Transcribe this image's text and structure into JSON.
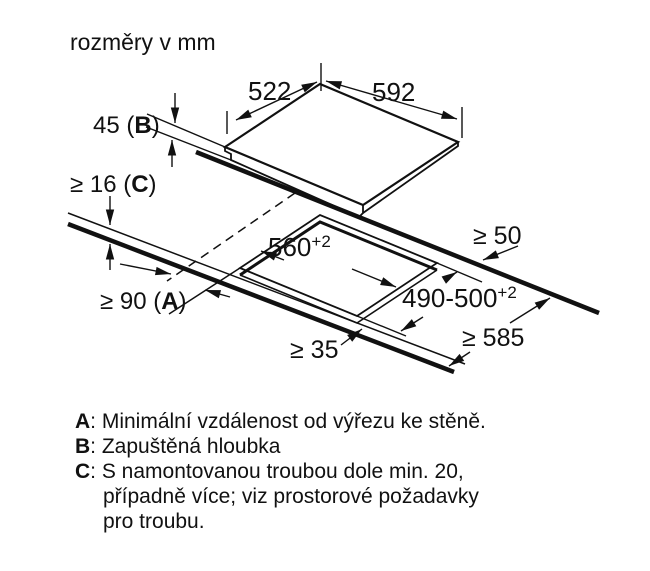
{
  "title": "rozměry v mm",
  "dimensions": {
    "width_top": "522",
    "width_right": "592",
    "depth_b": {
      "pre": "45 (",
      "letter": "B",
      "post": ")"
    },
    "thickness_c": {
      "pre": "≥ 16 (",
      "letter": "C",
      "post": ")"
    },
    "dist_a": {
      "pre": "≥ 90 (",
      "letter": "A",
      "post": ")"
    },
    "cutout_width": {
      "base": "560",
      "sup": "+2"
    },
    "cutout_depth": {
      "base": "490-500",
      "sup": "+2"
    },
    "back_clearance": "≥ 50",
    "worktop_depth": "≥ 585",
    "front_clearance": "≥ 35"
  },
  "legend": {
    "items": [
      {
        "letter": "A",
        "text": ": Minimální vzdálenost od výřezu ke stěně."
      },
      {
        "letter": "B",
        "text": ": Zapuštěná hloubka"
      },
      {
        "letter": "C",
        "text": ": S namontovanou troubou dole min. 20,"
      },
      {
        "letter": "",
        "text": "případně více; viz prostorové požadavky"
      },
      {
        "letter": "",
        "text": "pro troubu."
      }
    ]
  },
  "colors": {
    "ink": "#111111",
    "background": "#ffffff"
  }
}
